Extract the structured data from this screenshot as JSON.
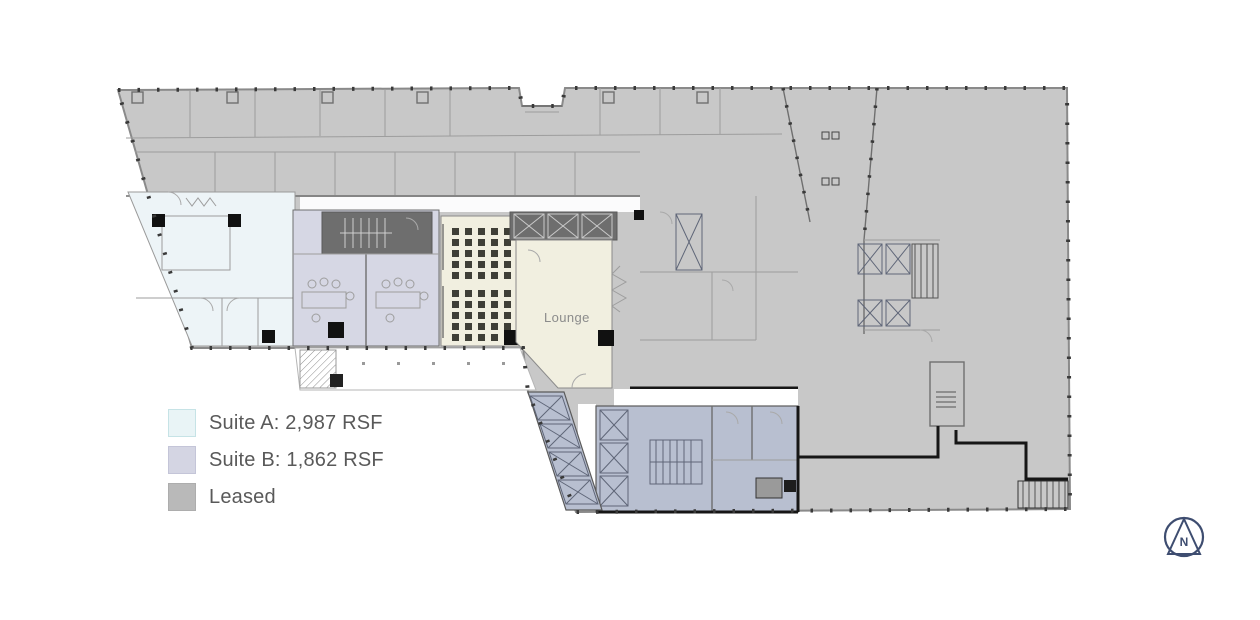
{
  "floor_plan": {
    "lounge_label": "Lounge"
  },
  "legend": {
    "items": [
      {
        "id": "suite-a",
        "label": "Suite A: 2,987 RSF",
        "color": "#e9f4f6"
      },
      {
        "id": "suite-b",
        "label": "Suite B: 1,862 RSF",
        "color": "#d4d5e3"
      },
      {
        "id": "leased",
        "label": "Leased",
        "color": "#b9b9b9"
      }
    ],
    "text_color": "#595959"
  },
  "north": {
    "letter": "N",
    "color": "#3e4d70"
  },
  "colors": {
    "leased_fill": "#c8c8c8",
    "suite_a_fill": "#edf4f7",
    "suite_b_fill": "#d6d7e4",
    "core_fill": "#b8bfd0",
    "lounge_fill": "#f1efe0",
    "wall": "#8a8a8a",
    "heavy_wall": "#161616"
  }
}
